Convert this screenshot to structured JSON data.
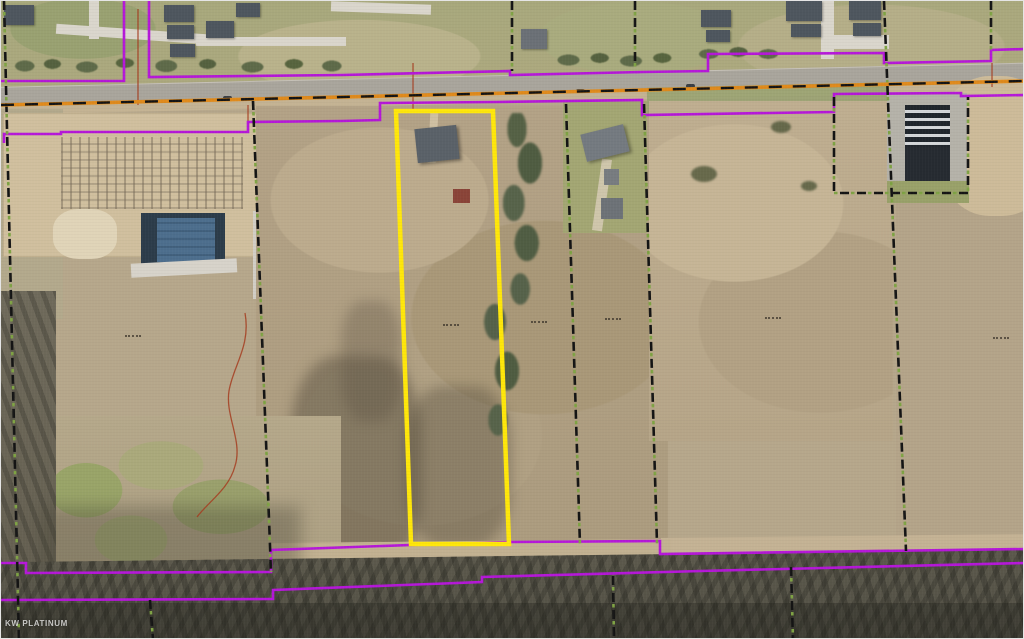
{
  "map": {
    "watermark": "KW PLATINUM",
    "colors": {
      "subject_parcel": "#ffe70a",
      "parcel_line": "#b517d8",
      "boundary_dash": "#141414",
      "boundary_dash_accent": "#7fa344",
      "road_centerline": "#df8a1c",
      "survey_line": "#a63d20"
    }
  }
}
